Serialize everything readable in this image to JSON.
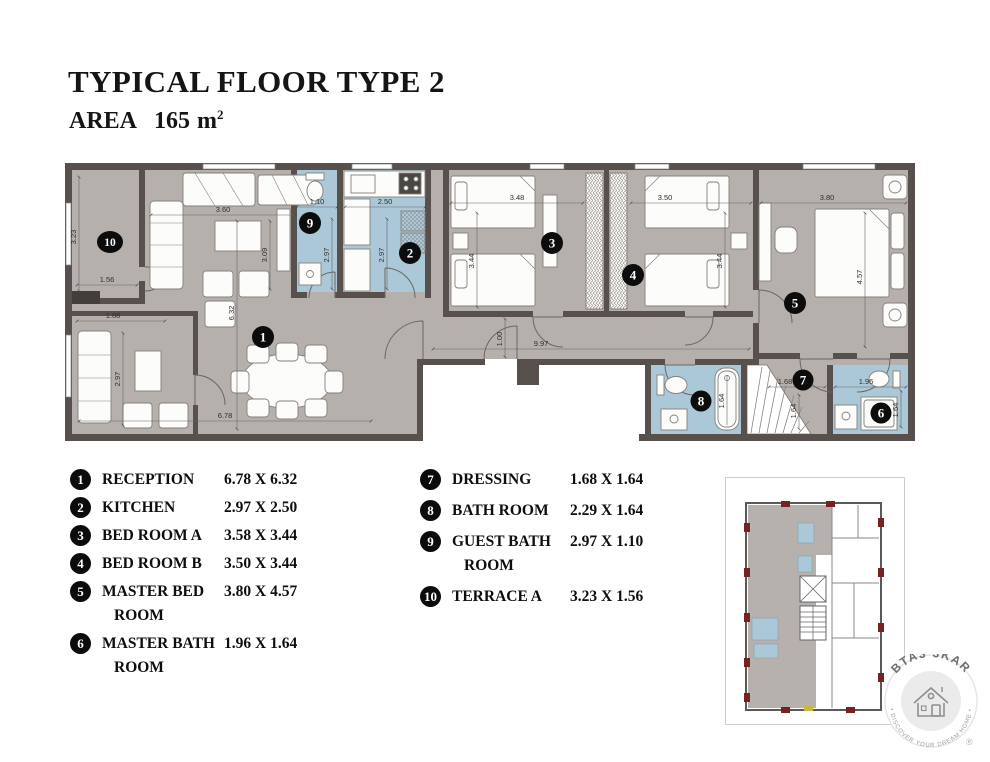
{
  "header": {
    "title": "TYPICAL FLOOR TYPE 2",
    "area_label": "AREA",
    "area_value": "165",
    "area_unit": "m",
    "area_sup": "2"
  },
  "plan": {
    "badges": [
      "1",
      "2",
      "3",
      "4",
      "5",
      "6",
      "7",
      "8",
      "9",
      "10"
    ],
    "dims": {
      "terrace_h": "3.23",
      "terrace_w": "1.56",
      "balcony_w": "1.68",
      "balcony_h": "2.97",
      "reception_top": "3.60",
      "reception_side": "3.09",
      "reception_h": "6.32",
      "reception_w": "6.78",
      "guestbath_w": "1.10",
      "guestbath_h": "2.97",
      "kitchen_w": "2.50",
      "kitchen_h": "2.97",
      "beda_w": "3.48",
      "beda_h": "3.44",
      "bedb_w": "3.50",
      "bedb_h": "3.44",
      "master_w": "3.80",
      "master_h": "4.57",
      "corridor_h": "1.00",
      "corridor_w": "9.97",
      "dressing_w": "1.68",
      "dressing_h": "1.64",
      "tub_l": "1.64",
      "masterbath_w": "1.96",
      "masterbath_h": "1.64"
    }
  },
  "legend": {
    "left": [
      {
        "num": "1",
        "name": "RECEPTION",
        "name2": "",
        "dims": "6.78 X 6.32"
      },
      {
        "num": "2",
        "name": "KITCHEN",
        "name2": "",
        "dims": "2.97 X 2.50"
      },
      {
        "num": "3",
        "name": "BED ROOM A",
        "name2": "",
        "dims": "3.58 X 3.44"
      },
      {
        "num": "4",
        "name": "BED ROOM B",
        "name2": "",
        "dims": "3.50 X 3.44"
      },
      {
        "num": "5",
        "name": "MASTER BED",
        "name2": "ROOM",
        "dims": "3.80 X 4.57"
      },
      {
        "num": "6",
        "name": "MASTER BATH",
        "name2": "ROOM",
        "dims": "1.96 X 1.64"
      }
    ],
    "right": [
      {
        "num": "7",
        "name": "DRESSING",
        "name2": "",
        "dims": "1.68 X 1.64"
      },
      {
        "num": "8",
        "name": "BATH ROOM",
        "name2": "",
        "dims": "2.29 X 1.64"
      },
      {
        "num": "9",
        "name": "GUEST BATH",
        "name2": "ROOM",
        "dims": "2.97 X 1.10"
      },
      {
        "num": "10",
        "name": "TERRACE A",
        "name2": "",
        "dims": "3.23 X 1.56"
      }
    ]
  },
  "logo": {
    "brand": "BTA3 3KAR",
    "tagline": "• DISCOVER YOUR DREAM HOME •",
    "registered": "®"
  },
  "colors": {
    "floor": "#b5b0ac",
    "wall": "#57504c",
    "wet_room": "#abc8d8",
    "badge": "#0c0c0c",
    "logo_gray": "#8f8f8f"
  }
}
